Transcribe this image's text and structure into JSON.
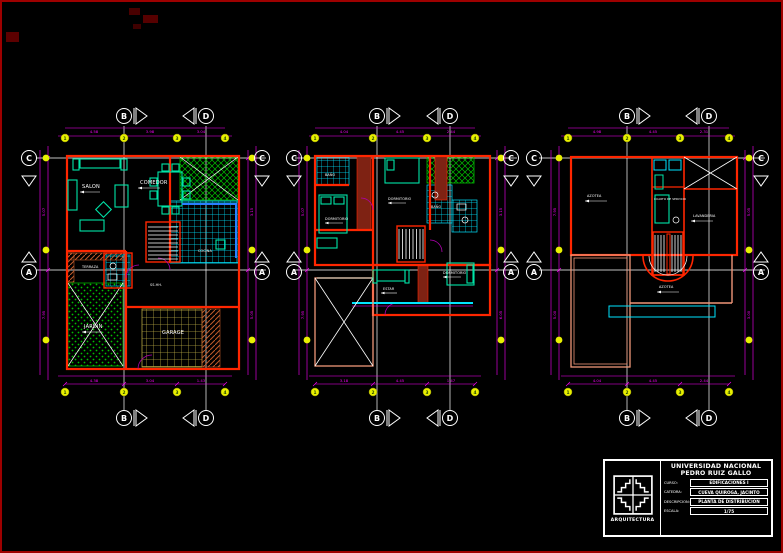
{
  "drawing": {
    "background": "#000000",
    "border_color": "#9e0000"
  },
  "colors": {
    "walls_red": "#ff2600",
    "walls_brown": "#7e2213",
    "hatch_brown": "#c05a2a",
    "furniture_green": "#00e5a8",
    "tile_cyan": "#00e5ff",
    "counter_blue": "#2a7fff",
    "garden_green": "#00c000",
    "garage_tan": "#b5a642",
    "dimension_magenta": "#ff00ff",
    "bubble_yellow": "#e8f000",
    "door_purple": "#b000b0",
    "terrace_salmon": "#ef9678",
    "text_white": "#ffffff"
  },
  "grid": {
    "col_b": "B",
    "col_d": "D",
    "row_c": "C",
    "row_a": "A",
    "nums": [
      "1",
      "2",
      "3",
      "4"
    ]
  },
  "plans": [
    {
      "id": "planta-primer-piso",
      "rooms": {
        "salon": "SALON",
        "comedor": "COMEDOR",
        "cocina": "COCINA",
        "terraza": "TERRAZA",
        "jardin": "JARDIN",
        "garage": "GARAGE",
        "bano": "SS.HH."
      },
      "dims": {
        "top": [
          "4.58",
          "3.98",
          "3.04"
        ],
        "bottom": [
          "4.38",
          "3.04",
          "1.43"
        ],
        "left": [
          "5.07",
          "7.95"
        ],
        "right": [
          "3.15",
          "5.05"
        ]
      }
    },
    {
      "id": "planta-segundo-piso",
      "rooms": {
        "dormitorio1": "DORMITORIO",
        "dormitorio2": "DORMITORIO",
        "dormitorio3": "DORMITORIO",
        "estar": "ESTAR",
        "bano1": "BAÑO",
        "bano2": "BAÑO"
      },
      "dims": {
        "top": [
          "4.04",
          "4.45",
          "2.44"
        ],
        "bottom": [
          "3.18",
          "4.45",
          "1.47"
        ],
        "left": [
          "5.07",
          "7.95"
        ],
        "right": [
          "3.15",
          "6.05"
        ]
      }
    },
    {
      "id": "planta-azotea",
      "rooms": {
        "azotea1": "AZOTEA",
        "azotea2": "AZOTEA",
        "cuarto_servicio": "CUARTO DE SERVICIO",
        "lavanderia": "LAVANDERIA"
      },
      "dims": {
        "top": [
          "4.98",
          "4.45",
          "2.31"
        ],
        "bottom": [
          "4.04",
          "4.45",
          "2.44"
        ],
        "left": [
          "7.95",
          "5.00"
        ],
        "right": [
          "5.05",
          "3.00"
        ]
      }
    }
  ],
  "title_block": {
    "university": [
      "UNIVERSIDAD NACIONAL",
      "PEDRO RUIZ GALLO"
    ],
    "department": "ARQUITECTURA",
    "fields": [
      {
        "label": "CURSO:",
        "value": "EDIFICACIONES I"
      },
      {
        "label": "CATEDRA:",
        "value": "CUEVA QUIROGA, JACINTO"
      },
      {
        "label": "DESCRIPCION:",
        "value": "PLANTA DE DISTRIBUCION"
      },
      {
        "label": "ESCALA:",
        "value": "1/75"
      }
    ]
  }
}
